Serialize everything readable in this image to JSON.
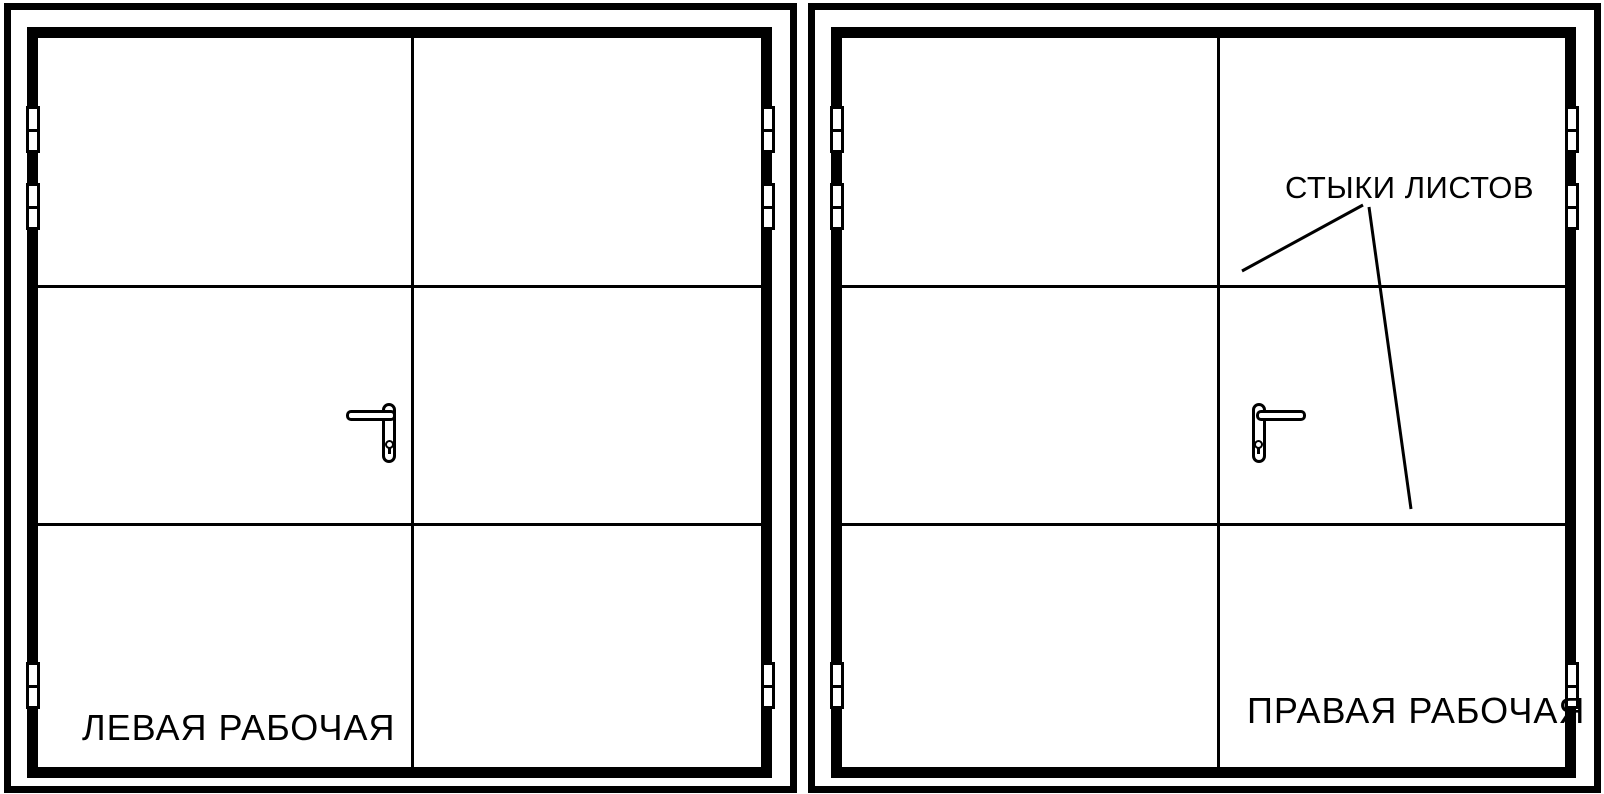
{
  "canvas": {
    "background": "#ffffff",
    "ink": "#000000",
    "width_px": 1604,
    "height_px": 794
  },
  "icons": {
    "hinge": "white rectangle with black outline split into two knuckles",
    "door-handle": "lever bar joined to rounded escutcheon plate",
    "keyhole": "small outlined circle with black stem below"
  },
  "doors": [
    {
      "id": "left-working-door",
      "label": "ЛЕВАЯ РАБОЧАЯ",
      "handle_leaf": "left",
      "leaves": 2,
      "sheet_rows": 3,
      "hinges_per_side": 3
    },
    {
      "id": "right-working-door",
      "label": "ПРАВАЯ РАБОЧАЯ",
      "annotation": "СТЫКИ ЛИСТОВ",
      "handle_leaf": "right",
      "leaves": 2,
      "sheet_rows": 3,
      "hinges_per_side": 3
    }
  ]
}
